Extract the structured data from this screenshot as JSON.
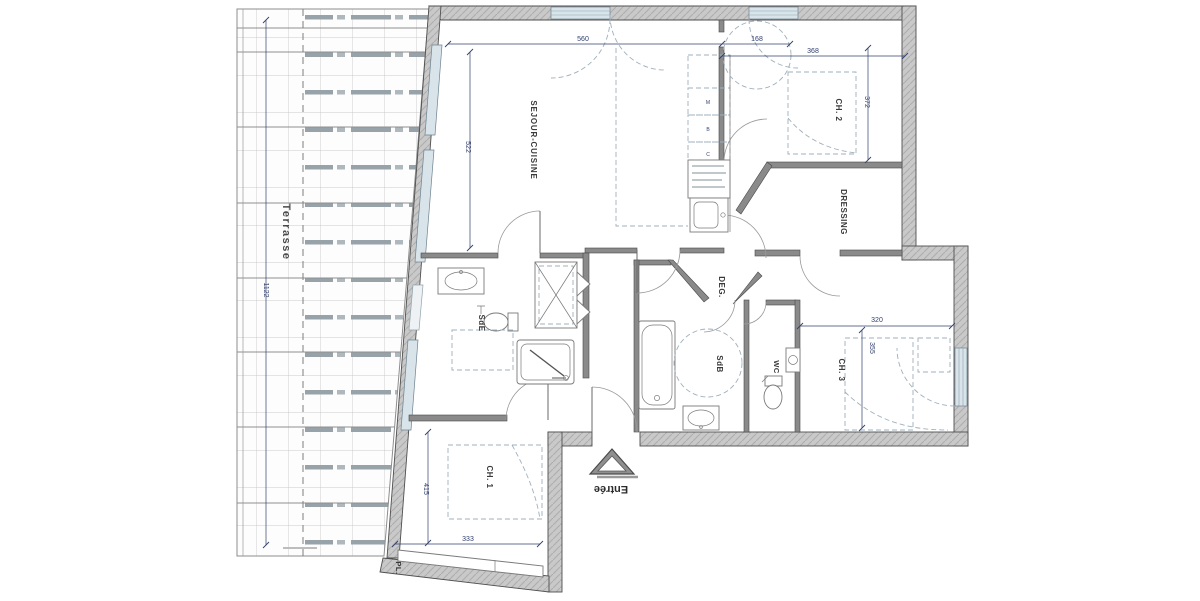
{
  "plan": {
    "type": "apartment-floor-plan",
    "rooms": {
      "terrasse": {
        "label": "Terrasse"
      },
      "sejour": {
        "label": "SEJOUR-CUISINE"
      },
      "ch2": {
        "label": "CH. 2"
      },
      "dressing": {
        "label": "DRESSING"
      },
      "deg": {
        "label": "DEG."
      },
      "sde": {
        "label": "SdE"
      },
      "sdb": {
        "label": "SdB"
      },
      "wc": {
        "label": "WC"
      },
      "ch3": {
        "label": "CH. 3"
      },
      "ch1": {
        "label": "CH. 1"
      },
      "pl": {
        "label": "PL."
      }
    },
    "dims": {
      "d560": "560",
      "d168": "168",
      "d368": "368",
      "d372": "372",
      "d522": "522",
      "d1122": "1122",
      "d320": "320",
      "d355": "355",
      "d415": "415",
      "d333": "333"
    },
    "entry": {
      "label": "Entrée"
    },
    "kitchen": {
      "marks": [
        "M",
        "B",
        "C"
      ]
    },
    "colors": {
      "wall_fill": "#c9c9c9",
      "wall_edge": "#4f4f4f",
      "glazing": "#d9e4ea",
      "dimension_text": "#32406e",
      "label_text": "#3a3a3a",
      "furniture_dash": "#9fb0bc"
    }
  }
}
